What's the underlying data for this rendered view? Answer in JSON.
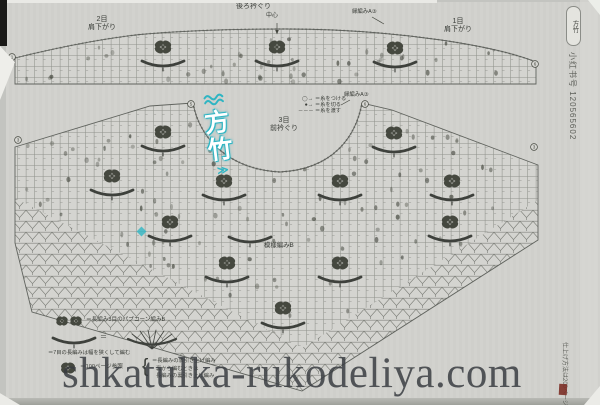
{
  "page": {
    "watermark": "shkatulka-rukodeliya.com",
    "side_id": "小红书号 120565602",
    "side_badge": "方竹",
    "side_note": "仕上げ方法は200ページへ",
    "brand": {
      "char1": "方",
      "char2": "竹",
      "tail": "≫"
    }
  },
  "labels": {
    "shoulder_left_1": "2目",
    "shoulder_left_2": "肩下がり",
    "back_neck": "後ろ衿ぐり",
    "center": "中心",
    "edging_top": "縁編みA③",
    "edging_mid": "縁編みA③",
    "shoulder_right_1": "1目",
    "shoulder_right_2": "肩下がり",
    "front_neck_1": "3目",
    "front_neck_2": "前衿ぐり",
    "pattern_b": "模様編みB"
  },
  "legend_top": [
    {
      "symbol": "◯→",
      "text": "＝糸をつける"
    },
    {
      "symbol": "●→",
      "text": "＝糸を切る"
    },
    {
      "symbol": "－－－",
      "text": "＝糸を渡す"
    }
  ],
  "legend_bottom": {
    "popcorn_sep": "・",
    "popcorn": "＝長編み5目のパプコーン編みB",
    "fan_eq": "＝",
    "fan_note": "＝7目の長編みは幅を狭くして編む",
    "ref": "＝100ページ参照",
    "brace": "{",
    "brace_1": "＝長編みの表引き上げ編み",
    "brace_2": "裏から編むときは",
    "brace_3": "長編みの裏引き上げ編み"
  },
  "diagram": {
    "colors": {
      "paper": "#d2d2ce",
      "background": "#c3c4c0",
      "grid_line": "#90928c",
      "mesh_line": "#7f817b",
      "symbol": "#45483f",
      "teal": "#2fb5c3",
      "watermark_text": "#3a3d42",
      "red_mark": "#7c2f27"
    },
    "flowers": [
      [
        163,
        47
      ],
      [
        277,
        47
      ],
      [
        395,
        48
      ],
      [
        163,
        132
      ],
      [
        394,
        133
      ],
      [
        112,
        176
      ],
      [
        224,
        181
      ],
      [
        340,
        181
      ],
      [
        452,
        181
      ],
      [
        170,
        222
      ],
      [
        450,
        222
      ],
      [
        227,
        263
      ],
      [
        340,
        263
      ],
      [
        283,
        308
      ]
    ],
    "fans": [
      [
        163,
        62
      ],
      [
        277,
        62
      ],
      [
        395,
        63
      ],
      [
        163,
        147
      ],
      [
        394,
        148
      ],
      [
        112,
        191
      ],
      [
        224,
        196
      ],
      [
        340,
        196
      ],
      [
        452,
        196
      ],
      [
        170,
        237
      ],
      [
        450,
        237
      ],
      [
        250,
        238
      ],
      [
        227,
        278
      ],
      [
        340,
        278
      ],
      [
        283,
        324
      ]
    ],
    "markers": [
      [
        12,
        57,
        "1"
      ],
      [
        535,
        64,
        "6"
      ],
      [
        18,
        140,
        "3"
      ],
      [
        191,
        104,
        "5"
      ],
      [
        365,
        104,
        "6"
      ],
      [
        534,
        147,
        "3"
      ]
    ],
    "dot_regions": [
      {
        "x": 25,
        "y": 37,
        "w": 505,
        "h": 45,
        "n": 46,
        "clip": "clip-band"
      },
      {
        "x": 22,
        "y": 106,
        "w": 512,
        "h": 238,
        "n": 165,
        "clip": "clip-grid"
      }
    ]
  }
}
